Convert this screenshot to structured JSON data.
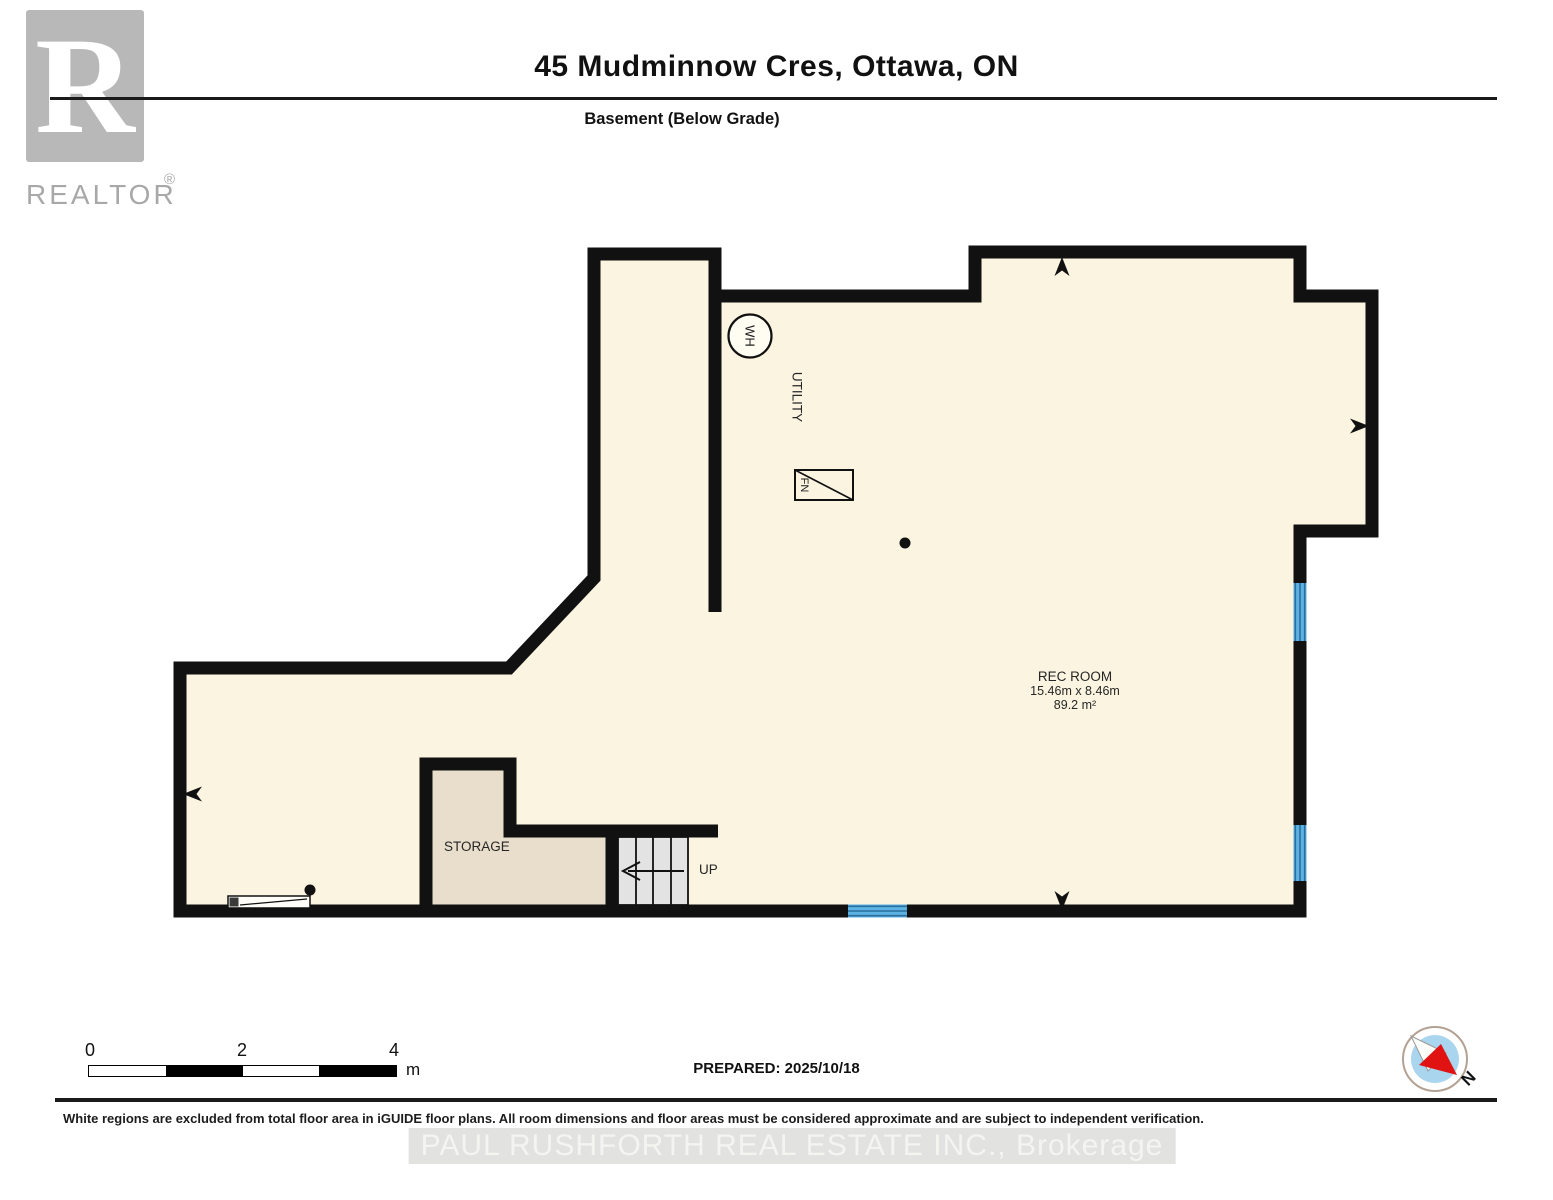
{
  "header": {
    "title": "45 Mudminnow Cres, Ottawa, ON",
    "subtitle": "Basement (Below Grade)",
    "logo_text": "REALTOR",
    "logo_reg": "®",
    "logo_letter": "R"
  },
  "plan": {
    "rooms": {
      "rec_room": {
        "name": "REC ROOM",
        "dimensions": "15.46m x 8.46m",
        "area": "89.2 m²"
      },
      "storage": {
        "name": "STORAGE"
      },
      "utility": {
        "name": "UTILITY"
      }
    },
    "labels": {
      "water_heater": "WH",
      "furnace": "FN",
      "stairs_up": "UP"
    },
    "colors": {
      "wall": "#111111",
      "floor": "#fbf4e0",
      "storage_floor": "#e8decb",
      "stairs": "#e3e3e3",
      "window": "#5db2e2",
      "window_stripe": "#2a6f9f"
    }
  },
  "footer": {
    "scale_bar": {
      "ticks": [
        "0",
        "2",
        "4"
      ],
      "unit": "m"
    },
    "prepared": "PREPARED: 2025/10/18",
    "compass": {
      "label": "N",
      "inner_color": "#a9d5ee",
      "needle_red": "#e01212"
    },
    "disclaimer": "White regions are excluded from total floor area in iGUIDE floor plans. All room dimensions and floor areas must be considered approximate and are subject to independent verification.",
    "watermark": "PAUL RUSHFORTH REAL ESTATE INC., Brokerage"
  }
}
